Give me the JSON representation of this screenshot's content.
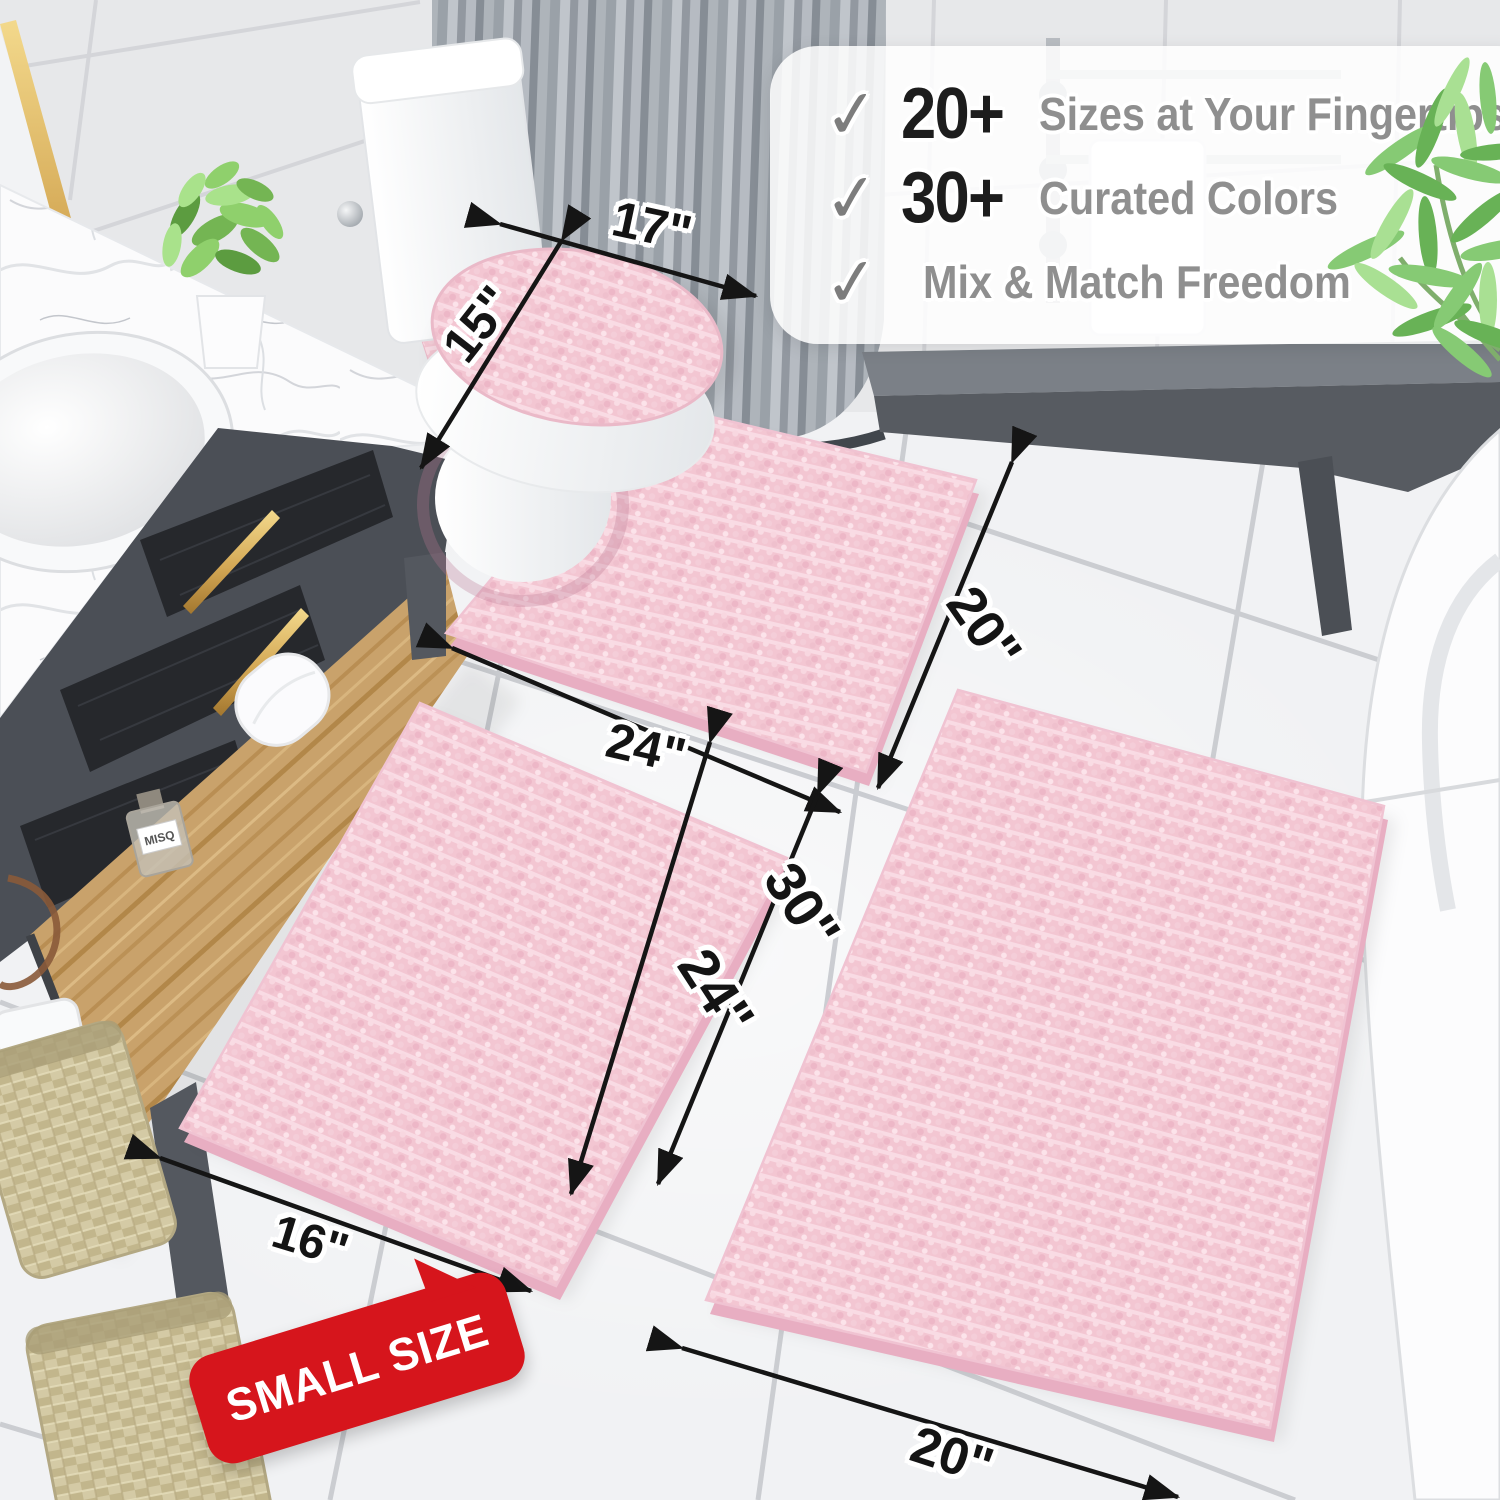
{
  "panel": {
    "items": [
      {
        "check": "✓",
        "count": "20+",
        "label": "Sizes at Your Fingertips"
      },
      {
        "check": "✓",
        "count": "30+",
        "label": "Curated Colors"
      },
      {
        "check": "✓",
        "count": "",
        "label": "Mix & Match Freedom"
      }
    ]
  },
  "dims": {
    "lid_width": "17\"",
    "lid_depth": "15\"",
    "contour_width": "24\"",
    "contour_depth": "20\"",
    "large_rug_length": "30\"",
    "small_rug_length": "24\"",
    "small_rug_width": "16\"",
    "large_rug_width": "20\""
  },
  "badge": {
    "text": "SMALL SIZE"
  },
  "decor": {
    "perfume_label": "MISQ"
  },
  "colors": {
    "rug_pink": "#f3c6d2",
    "badge_red": "#d6151c",
    "number_black": "#1d1d1d",
    "label_gray": "#8f8f8f",
    "check_gray": "#7d7d7d"
  }
}
